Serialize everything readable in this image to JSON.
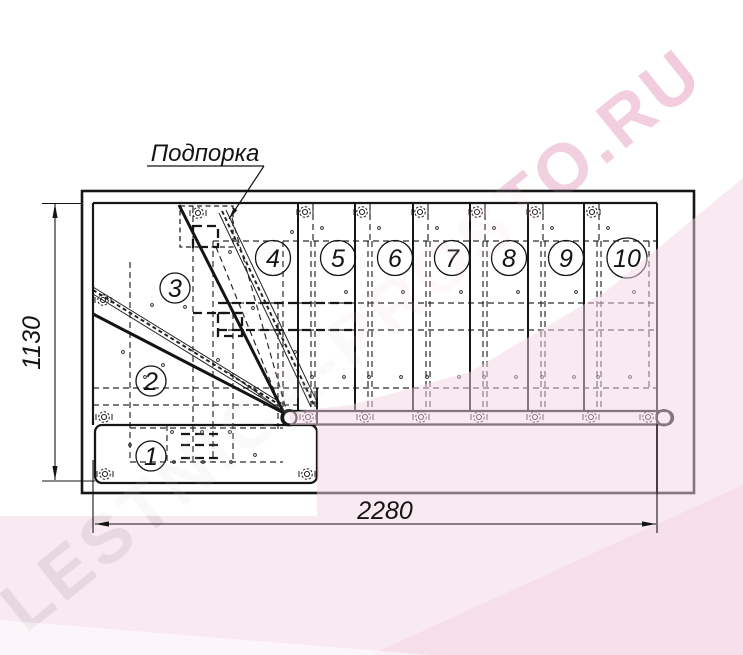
{
  "watermark": {
    "text": "LESTNICA-PROSTO.RU"
  },
  "callout": {
    "label": "Подпорка"
  },
  "dimensions": {
    "width": "2280",
    "height": "1130"
  },
  "steps": {
    "labels": [
      "1",
      "2",
      "3",
      "4",
      "5",
      "6",
      "7",
      "8",
      "9",
      "10"
    ]
  },
  "colors": {
    "line": "#161616",
    "watermark_gray": "#d8d8d8",
    "watermark_pink": "#f1c3d7",
    "tint_pink": "#f3d3e4",
    "background": "#ffffff"
  }
}
